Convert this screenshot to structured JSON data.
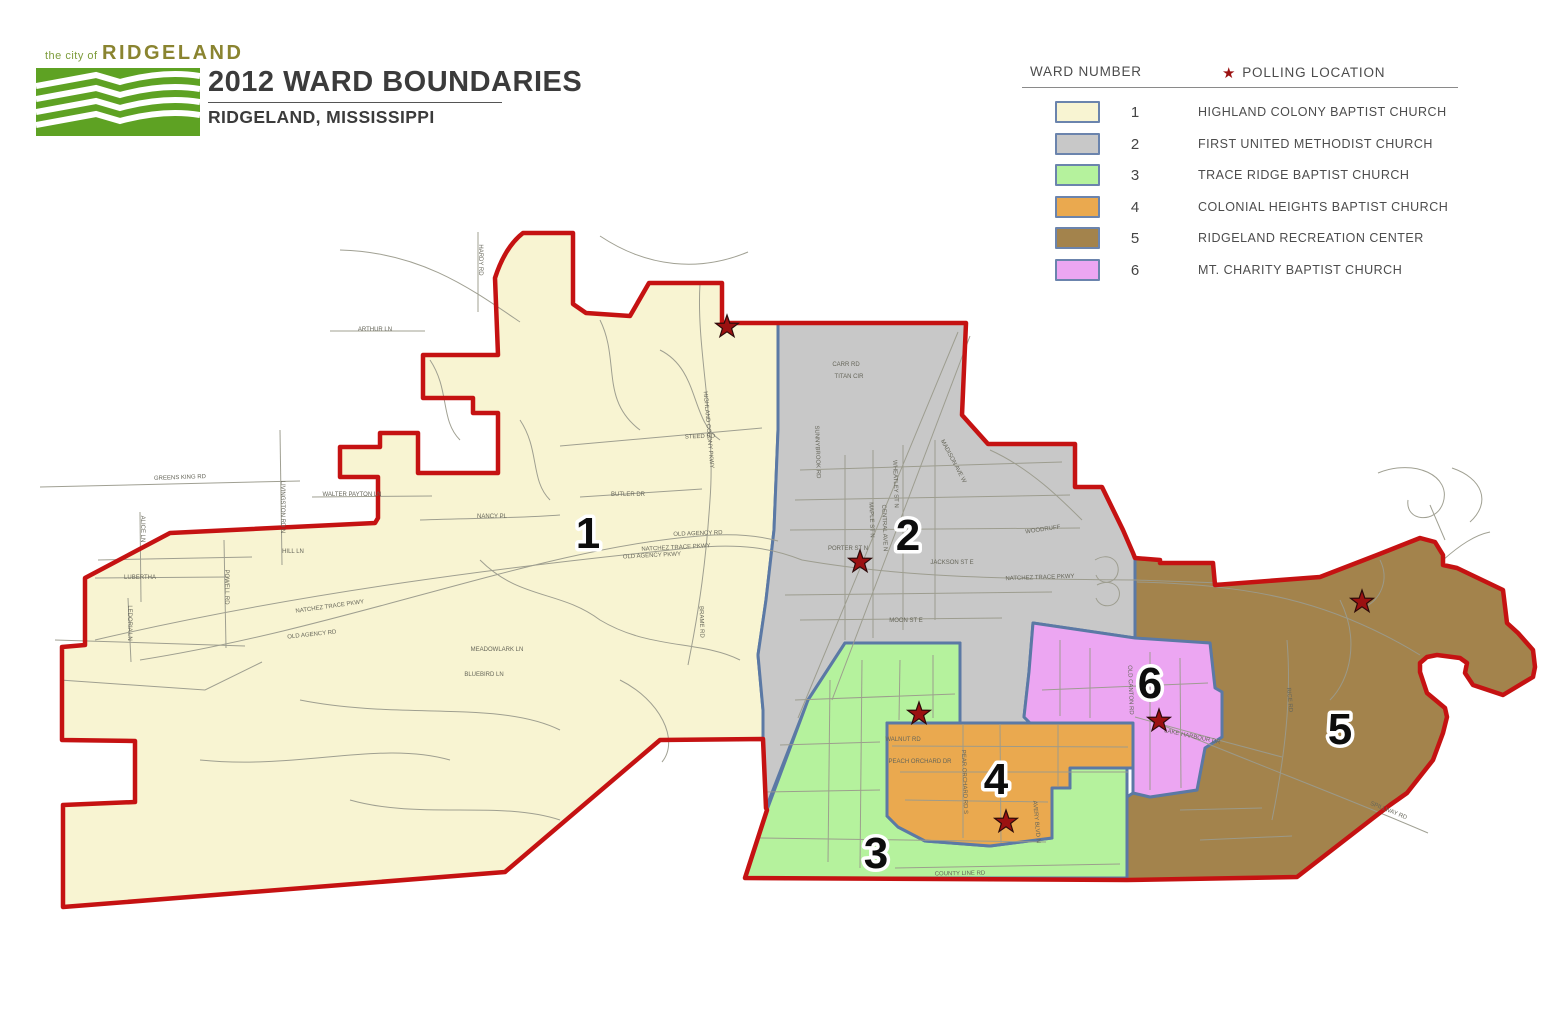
{
  "header": {
    "logo": {
      "small_text": "the city of",
      "brand": "RIDGELAND",
      "box_color": "#5ea223"
    },
    "title": "2012 WARD BOUNDARIES",
    "subtitle": "RIDGELAND, MISSISSIPPI"
  },
  "legend": {
    "ward_number_label": "WARD NUMBER",
    "polling_label": "POLLING LOCATION",
    "swatch_border": "#6b84ad",
    "rows": [
      {
        "ward": "1",
        "location": "HIGHLAND COLONY BAPTIST CHURCH",
        "color": "#f8f4d2"
      },
      {
        "ward": "2",
        "location": "FIRST UNITED METHODIST CHURCH",
        "color": "#c8c8c8"
      },
      {
        "ward": "3",
        "location": "TRACE RIDGE BAPTIST CHURCH",
        "color": "#b5f29d"
      },
      {
        "ward": "4",
        "location": "COLONIAL HEIGHTS BAPTIST CHURCH",
        "color": "#eaa94f"
      },
      {
        "ward": "5",
        "location": "RIDGELAND RECREATION CENTER",
        "color": "#a3834c"
      },
      {
        "ward": "6",
        "location": "MT. CHARITY BAPTIST CHURCH",
        "color": "#eca6f2"
      }
    ]
  },
  "map": {
    "boundary_color": "#c51212",
    "inner_border_color": "#5b79a5",
    "street_color": "#9b9b8d",
    "street_label_color": "#66665a",
    "star_color": "#9b1111",
    "star_outline": "#2d0a0a",
    "city_boundary_path": "M495,278 Q505,247 523,233 L573,233 L573,304 L586,313 L630,316 L649,283 L722,283 L722,323 L778,323 L966,323 L962,415 L988,444 L1075,444 L1075,487 L1102,487 L1123,530 L1133,553 L1135,558 L1160,560 L1160,563 L1213,563 L1215,585 L1320,577 L1377,555 L1420,538 L1435,542 L1443,555 L1443,565 L1457,568 L1503,590 L1507,623 L1518,633 L1533,650 L1535,667 L1533,677 L1508,692 L1503,695 L1473,685 L1465,673 L1467,663 L1460,658 L1437,655 L1427,657 L1420,663 L1420,672 L1427,693 L1445,708 L1447,717 L1443,733 L1433,760 L1407,793 L1390,805 L1297,877 L1127,880 L745,878 L767,810 L766,808 L763,739 L660,740 L505,872 L63,907 L63,805 L135,802 L135,741 L62,740 L62,647 L85,645 L85,578 L170,533 L375,523 L378,518 L378,477 L340,477 L340,447 L380,447 L380,433 L418,433 L418,473 L498,473 L498,413 L473,413 L473,398 L423,398 L423,355 L498,355 Z",
    "wards": [
      {
        "number": "1",
        "fill": "#f8f4d2",
        "label": {
          "x": 588,
          "y": 532
        },
        "star": {
          "x": 727,
          "y": 327
        },
        "path": "M495,278 Q505,247 523,233 L573,233 L573,304 L586,313 L630,316 L649,283 L722,283 L722,323 L778,323 L778,430 L774,530 L766,600 L758,655 L763,710 L763,739 L660,740 L505,872 L63,907 L63,805 L135,802 L135,741 L62,740 L62,647 L85,645 L85,578 L170,533 L375,523 L378,518 L378,477 L340,477 L340,447 L380,447 L380,433 L418,433 L418,473 L498,473 L498,413 L473,413 L473,398 L423,398 L423,355 L498,355 Z"
      },
      {
        "number": "2",
        "fill": "#c8c8c8",
        "label": {
          "x": 908,
          "y": 534
        },
        "star": {
          "x": 860,
          "y": 562
        },
        "path": "M778,323 L966,323 L962,415 L988,444 L1075,444 L1075,487 L1102,487 L1123,530 L1133,553 L1135,558 L1135,638 L1033,623 L1029,672 L1024,717 L1030,723 L960,723 L960,643 L845,643 L808,700 L766,808 L763,739 L763,710 L758,655 L766,600 L774,530 L778,430 Z"
      },
      {
        "number": "3",
        "fill": "#b5f29d",
        "label": {
          "x": 876,
          "y": 852
        },
        "star": {
          "x": 919,
          "y": 714
        },
        "path": "M845,643 L960,643 L960,723 L887,723 L887,816 L898,827 L925,841 L990,846 L1052,838 L1052,788 L1070,788 L1070,768 L1127,768 L1127,878 L745,878 L767,810 L808,700 Z"
      },
      {
        "number": "4",
        "fill": "#eaa94f",
        "label": {
          "x": 996,
          "y": 778
        },
        "star": {
          "x": 1006,
          "y": 822
        },
        "path": "M887,723 L1133,723 L1133,768 L1070,768 L1070,788 L1052,788 L1052,838 L990,846 L925,841 L898,827 L887,816 Z"
      },
      {
        "number": "5",
        "fill": "#a3834c",
        "label": {
          "x": 1340,
          "y": 728
        },
        "star": {
          "x": 1362,
          "y": 602
        },
        "path": "M1135,558 L1160,560 L1160,563 L1213,563 L1215,585 L1320,577 L1377,555 L1420,538 L1435,542 L1443,555 L1443,565 L1457,568 L1503,590 L1507,623 L1518,633 L1533,650 L1535,667 L1533,677 L1508,692 L1503,695 L1473,685 L1465,673 L1467,663 L1460,658 L1437,655 L1427,657 L1420,663 L1420,672 L1427,693 L1445,708 L1447,717 L1443,733 L1433,760 L1407,793 L1390,805 L1297,877 L1127,880 L1127,797 L1133,793 L1150,797 L1197,790 L1205,748 L1222,737 L1222,692 L1215,688 L1210,643 L1135,640 Z"
      },
      {
        "number": "6",
        "fill": "#eca6f2",
        "label": {
          "x": 1150,
          "y": 682
        },
        "star": {
          "x": 1159,
          "y": 721
        },
        "path": "M1033,623 L1135,638 L1210,643 L1215,688 L1222,692 L1222,737 L1205,748 L1197,790 L1150,797 L1133,793 L1133,723 L1030,723 L1024,717 L1029,672 Z"
      }
    ],
    "street_labels": [
      {
        "text": "ARTHUR LN",
        "x": 375,
        "y": 331,
        "rot": 0
      },
      {
        "text": "HARDY RD",
        "x": 479,
        "y": 260,
        "rot": 90
      },
      {
        "text": "GREENS KING RD",
        "x": 180,
        "y": 479,
        "rot": -2
      },
      {
        "text": "WALTER PAYTON LN",
        "x": 352,
        "y": 496,
        "rot": 0
      },
      {
        "text": "LIVINGSTON RD N",
        "x": 281,
        "y": 507,
        "rot": 90
      },
      {
        "text": "ALICE LN",
        "x": 141,
        "y": 529,
        "rot": 90
      },
      {
        "text": "HILL LN",
        "x": 293,
        "y": 553,
        "rot": 0
      },
      {
        "text": "LUBERTHA",
        "x": 140,
        "y": 579,
        "rot": 0
      },
      {
        "text": "POWELL RD",
        "x": 225,
        "y": 587,
        "rot": 90
      },
      {
        "text": "LEDORIA LN",
        "x": 128,
        "y": 623,
        "rot": 90
      },
      {
        "text": "NATCHEZ TRACE PKWY",
        "x": 330,
        "y": 608,
        "rot": -8
      },
      {
        "text": "OLD AGENCY RD",
        "x": 312,
        "y": 636,
        "rot": -6
      },
      {
        "text": "OLD AGENCY RD",
        "x": 698,
        "y": 535,
        "rot": -2
      },
      {
        "text": "NATCHEZ TRACE PKWY",
        "x": 676,
        "y": 549,
        "rot": -3
      },
      {
        "text": "OLD AGENCY PKWY",
        "x": 652,
        "y": 557,
        "rot": -3
      },
      {
        "text": "STEED RD",
        "x": 700,
        "y": 438,
        "rot": -2
      },
      {
        "text": "BUTLER DR",
        "x": 628,
        "y": 496,
        "rot": 0
      },
      {
        "text": "NANCY PL",
        "x": 492,
        "y": 518,
        "rot": 0
      },
      {
        "text": "MEADOWLARK LN",
        "x": 497,
        "y": 651,
        "rot": 0
      },
      {
        "text": "BLUEBIRD LN",
        "x": 484,
        "y": 676,
        "rot": 0
      },
      {
        "text": "HIGHLAND COLONY PKWY",
        "x": 707,
        "y": 430,
        "rot": 85
      },
      {
        "text": "BRAME RD",
        "x": 700,
        "y": 622,
        "rot": 88
      },
      {
        "text": "SUNNYBROOK RD",
        "x": 816,
        "y": 452,
        "rot": 88
      },
      {
        "text": "CARR RD",
        "x": 846,
        "y": 366,
        "rot": 0
      },
      {
        "text": "TITAN CIR",
        "x": 849,
        "y": 378,
        "rot": 0
      },
      {
        "text": "MADISON AVE W",
        "x": 952,
        "y": 462,
        "rot": 62
      },
      {
        "text": "WHEATLEY ST N",
        "x": 894,
        "y": 484,
        "rot": 88
      },
      {
        "text": "MAPLE ST N",
        "x": 870,
        "y": 520,
        "rot": 88
      },
      {
        "text": "CENTRAL AVE N",
        "x": 883,
        "y": 528,
        "rot": 88
      },
      {
        "text": "WOODRUFF",
        "x": 1043,
        "y": 531,
        "rot": -8
      },
      {
        "text": "PORTER ST N",
        "x": 848,
        "y": 550,
        "rot": 0
      },
      {
        "text": "JACKSON ST E",
        "x": 952,
        "y": 564,
        "rot": 0
      },
      {
        "text": "NATCHEZ TRACE PKWY",
        "x": 1040,
        "y": 579,
        "rot": -2
      },
      {
        "text": "MOON ST E",
        "x": 906,
        "y": 622,
        "rot": 0
      },
      {
        "text": "OLD CANTON RD",
        "x": 1129,
        "y": 690,
        "rot": 88
      },
      {
        "text": "LAKE HARBOUR DR",
        "x": 1192,
        "y": 738,
        "rot": 12
      },
      {
        "text": "PEAR ORCHARD RD S",
        "x": 963,
        "y": 782,
        "rot": 88
      },
      {
        "text": "WALNUT RD",
        "x": 903,
        "y": 741,
        "rot": 0
      },
      {
        "text": "PEACH ORCHARD DR",
        "x": 920,
        "y": 763,
        "rot": 0
      },
      {
        "text": "AVERY BLVD N",
        "x": 1035,
        "y": 822,
        "rot": 85
      },
      {
        "text": "COUNTY LINE RD",
        "x": 960,
        "y": 875,
        "rot": -1
      },
      {
        "text": "SPILLWAY RD",
        "x": 1388,
        "y": 812,
        "rot": 22
      },
      {
        "text": "RICE RD",
        "x": 1288,
        "y": 700,
        "rot": 85
      }
    ],
    "streets": [
      "M40,487 L300,481",
      "M280,430 L282,565",
      "M312,497 L432,496",
      "M98,560 L252,557",
      "M95,578 L228,577",
      "M140,512 L141,602",
      "M224,540 L226,648",
      "M128,598 L131,662",
      "M55,640 L245,646",
      "M60,680 L205,690 L262,662",
      "M330,331 L425,331",
      "M478,232 L478,312",
      "M340,250 C420,252 470,288 520,322",
      "M600,236 C648,268 700,272 748,252",
      "M1378,473 C1415,458 1452,476 1443,503 C1436,524 1405,522 1408,500",
      "M1452,468 C1482,478 1492,502 1470,522",
      "M1430,505 L1445,540",
      "M95,640 C300,592 520,565 690,548 C740,543 772,548 802,560 C900,577 1000,579 1135,580 C1200,582 1230,583 1250,584",
      "M140,660 C350,627 540,548 700,536 C735,533 760,536 778,541",
      "M700,284 C696,350 716,420 710,500 C706,560 700,605 688,665",
      "M560,446 L762,428",
      "M580,497 L702,489",
      "M420,520 C480,518 522,518 560,515",
      "M600,320 C620,360 600,400 640,430",
      "M660,350 C700,370 690,420 720,440",
      "M480,560 C520,600 560,590 600,620 C650,650 700,640 740,660",
      "M300,700 C400,720 500,700 560,730",
      "M200,760 C300,770 380,740 450,760",
      "M350,800 C420,820 500,800 560,820",
      "M620,680 C660,700 680,740 662,762",
      "M520,420 C540,450 530,480 550,500",
      "M430,360 C450,390 440,420 460,440",
      "M845,455 L845,640",
      "M873,450 L873,638",
      "M903,445 L903,630",
      "M935,440 L935,620",
      "M800,470 L1062,462",
      "M795,500 L1070,495",
      "M790,530 L1080,528",
      "M785,595 L1052,592",
      "M800,620 L1002,618",
      "M958,332 L798,718",
      "M970,336 L832,700",
      "M990,450 C1030,468 1062,500 1082,520",
      "M1095,560 C1108,552 1120,560 1118,572 C1116,584 1100,586 1096,575",
      "M1097,585 C1110,578 1122,586 1119,597 C1116,608 1100,609 1096,598",
      "M862,660 L860,868",
      "M830,680 L828,862",
      "M900,660 L899,720",
      "M933,655 L933,718",
      "M795,700 L955,694",
      "M780,745 L880,742",
      "M765,792 L880,790",
      "M760,838 L1046,842",
      "M895,868 L1120,864",
      "M892,746 L1128,747",
      "M900,772 L1128,772",
      "M905,800 L1048,802",
      "M963,724 L963,838",
      "M1000,724 L1001,843",
      "M1058,725 L1058,786",
      "M1060,640 L1060,716",
      "M1090,648 L1090,718",
      "M1150,652 L1150,790",
      "M1180,658 L1181,788",
      "M1042,690 L1208,683",
      "M1135,717 L1222,741 L1282,757",
      "M1137,582 C1250,585 1330,600 1420,655",
      "M1287,640 C1292,700 1284,760 1272,820",
      "M1150,720 C1250,762 1352,800 1428,833",
      "M1340,600 C1360,640 1350,680 1330,700",
      "M1380,560 C1390,580 1380,600 1365,607",
      "M1180,810 L1262,808",
      "M1200,840 L1292,836",
      "M1443,560 C1460,545 1475,535 1490,532"
    ]
  }
}
